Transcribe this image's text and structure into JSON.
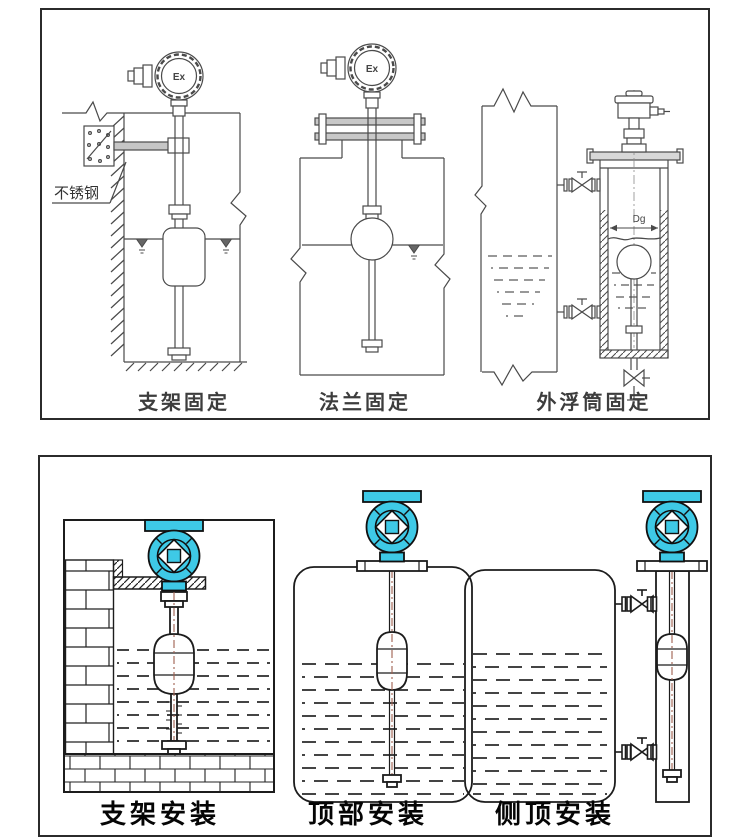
{
  "colors": {
    "accent": "#3ec9e6",
    "centerline": "#9e5f4e"
  },
  "top_panel": {
    "captions": [
      "支架固定",
      "法兰固定",
      "外浮筒固定"
    ],
    "labels": {
      "material": "不锈钢",
      "ex_left": "Ex",
      "ex_middle": "Ex",
      "diameter": "Dg"
    }
  },
  "bottom_panel": {
    "captions": [
      "支架安装",
      "顶部安装",
      "侧顶安装"
    ]
  }
}
